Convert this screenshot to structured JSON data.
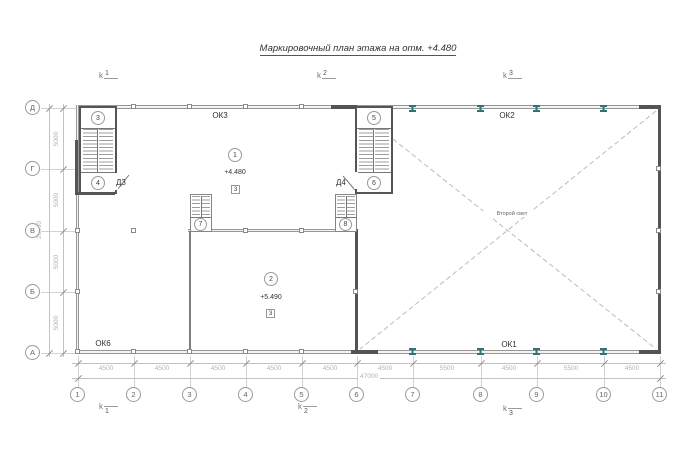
{
  "title": "Маркировочный план этажа на отм. +4.480",
  "grid": {
    "cols": [
      "1",
      "2",
      "3",
      "4",
      "5",
      "6",
      "7",
      "8",
      "9",
      "10",
      "11"
    ],
    "rows": [
      "Д",
      "Г",
      "В",
      "Б",
      "А"
    ]
  },
  "dims": {
    "bottom": [
      "4500",
      "4500",
      "4500",
      "4500",
      "4500",
      "4500",
      "5500",
      "4500",
      "5500",
      "4500"
    ],
    "bottom_total": "47000",
    "left": [
      "5000",
      "5000",
      "5000",
      "5000"
    ],
    "left_total": "20000"
  },
  "sections": {
    "prefix": "k",
    "s1": "1",
    "s2": "2",
    "s3": "3"
  },
  "rooms": {
    "room1": {
      "mark": "1",
      "elevation": "+4.480",
      "floor_type": "3"
    },
    "room2": {
      "mark": "2",
      "elevation": "+5.490",
      "floor_type": "3"
    }
  },
  "stair_marks": {
    "m3": "3",
    "m4": "4",
    "m5": "5",
    "m6": "6",
    "m7": "7",
    "m8": "8"
  },
  "doors": {
    "d3": "Д3",
    "d4": "Д4"
  },
  "windows": {
    "ok1": "ОК1",
    "ok2": "ОК2",
    "ok3": "ОК3",
    "ok6": "ОК6"
  },
  "annotations": {
    "second_light": "Второй свет"
  },
  "colors": {
    "wall_dark": "#545454",
    "line_gray": "#9a9a9a",
    "dim_gray": "#b2b2b2",
    "beam_teal": "#2e7474"
  }
}
